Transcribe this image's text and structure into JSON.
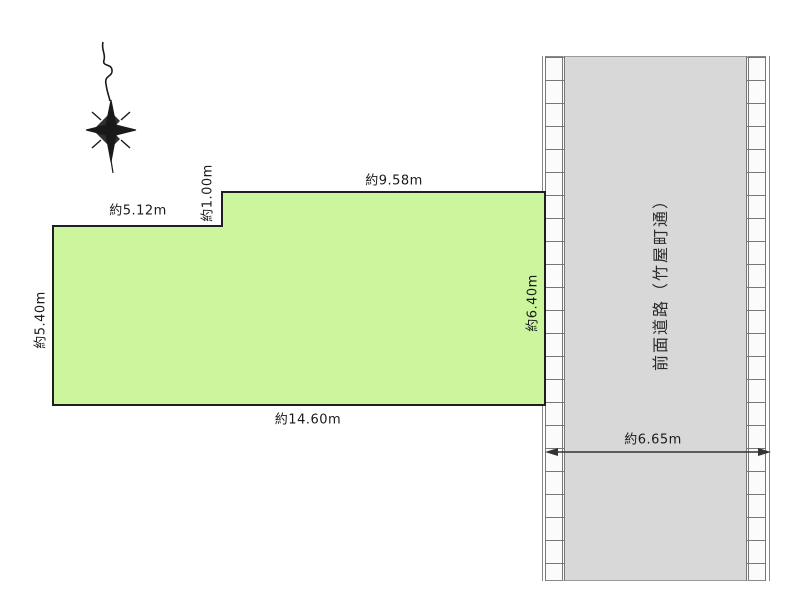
{
  "diagram": {
    "title": "land-plot-site-diagram",
    "plot": {
      "fill_color": "#cbf69d",
      "outline_color": "#1f1f1f",
      "dimensions": {
        "top_left_width": "約5.12m",
        "step_depth": "約1.00m",
        "top_right_width": "約9.58m",
        "left_depth": "約5.40m",
        "right_depth": "約6.40m",
        "bottom_width": "約14.60m"
      }
    },
    "road": {
      "name": "前面道路（竹屋町通）",
      "width_label": "約6.65m",
      "surface_color": "#d8d8d8",
      "hatch_line_color": "#777777"
    },
    "icons": {
      "compass": "north-compass-star-icon"
    }
  }
}
